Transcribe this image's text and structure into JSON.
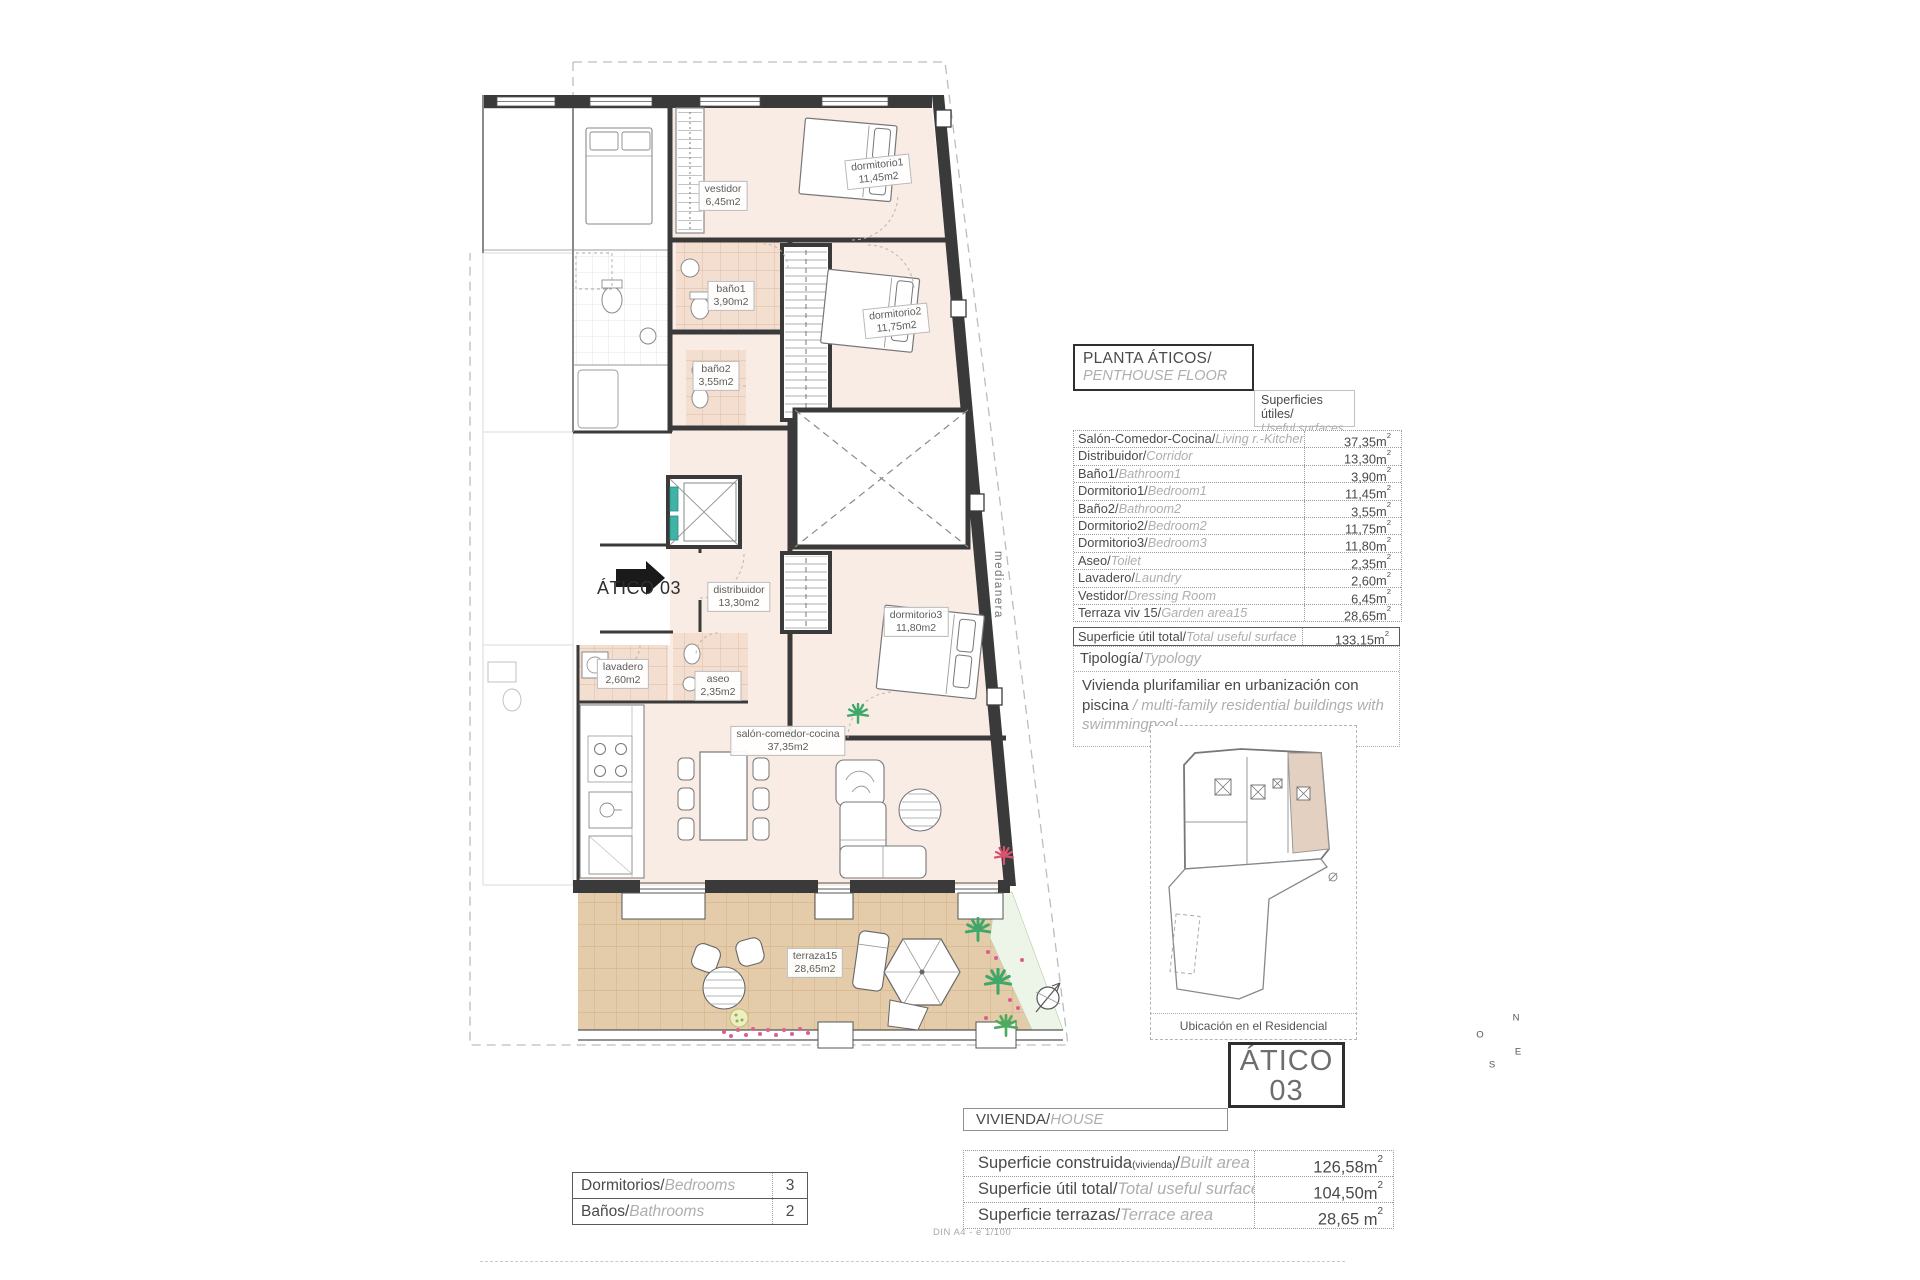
{
  "units": {
    "m": "m",
    "sup2": "2"
  },
  "page": {
    "footer": "DIN A4 - e 1/100"
  },
  "plan": {
    "arrow_label": "ÁTICO 03",
    "medianera": "medianera",
    "compass": {
      "n": "N",
      "o": "O",
      "s": "S",
      "e": "E"
    },
    "labels": [
      {
        "name": "vestidor",
        "area": "6,45m2"
      },
      {
        "name": "dormitorio1",
        "area": "11,45m2"
      },
      {
        "name": "baño1",
        "area": "3,90m2"
      },
      {
        "name": "baño2",
        "area": "3,55m2"
      },
      {
        "name": "dormitorio2",
        "area": "11,75m2"
      },
      {
        "name": "distribuidor",
        "area": "13,30m2"
      },
      {
        "name": "dormitorio3",
        "area": "11,80m2"
      },
      {
        "name": "lavadero",
        "area": "2,60m2"
      },
      {
        "name": "aseo",
        "area": "2,35m2"
      },
      {
        "name": "salón-comedor-cocina",
        "area": "37,35m2"
      },
      {
        "name": "terraza15",
        "area": "28,65m2"
      }
    ]
  },
  "title_block": {
    "es": "PLANTA ÁTICOS/",
    "en": "PENTHOUSE FLOOR"
  },
  "surfaces_header": {
    "es": "Superficies útiles/",
    "en": "Useful surfaces"
  },
  "surfaces_table": {
    "rows": [
      {
        "es": "Salón-Comedor-Cocina/",
        "en": "Living r.-Kitchen",
        "value": "37,35"
      },
      {
        "es": "Distribuidor/",
        "en": "Corridor",
        "value": "13,30"
      },
      {
        "es": "Baño1/",
        "en": "Bathroom1",
        "value": "3,90"
      },
      {
        "es": "Dormitorio1/",
        "en": "Bedroom1",
        "value": "11,45"
      },
      {
        "es": "Baño2/",
        "en": "Bathroom2",
        "value": "3,55"
      },
      {
        "es": "Dormitorio2/",
        "en": "Bedroom2",
        "value": "11,75"
      },
      {
        "es": "Dormitorio3/",
        "en": "Bedroom3",
        "value": "11,80"
      },
      {
        "es": "Aseo/",
        "en": "Toilet",
        "value": "2,35"
      },
      {
        "es": "Lavadero/",
        "en": "Laundry",
        "value": "2,60"
      },
      {
        "es": "Vestidor/",
        "en": "Dressing Room",
        "value": "6,45"
      },
      {
        "es": "Terraza viv 15/",
        "en": "Garden area15",
        "value": "28,65"
      }
    ],
    "total": {
      "es": "Superficie útil total/",
      "en": "Total useful surface",
      "value": "133,15"
    }
  },
  "typology": {
    "header_es": "Tipología/",
    "header_en": "Typology",
    "body_es": "Vivienda plurifamiliar en urbanización con piscina",
    "sep": " / ",
    "body_en": "multi-family residential buildings with swimmingpool"
  },
  "location": {
    "caption": "Ubicación en el Residencial"
  },
  "unit_box": {
    "line1": "ÁTICO",
    "line2": "03"
  },
  "vivienda_bar": {
    "es": "VIVIENDA/",
    "en": "HOUSE"
  },
  "house_table": {
    "rows": [
      {
        "es": "Superficie construida",
        "small": "(vivienda)",
        "slash": "/",
        "en": "Built area",
        "value": "126,58"
      },
      {
        "es": "Superficie útil total",
        "small": "",
        "slash": "/",
        "en": "Total useful surfaces",
        "value": "104,50"
      },
      {
        "es": "Superficie terrazas",
        "small": "",
        "slash": "/",
        "en": "Terrace area",
        "value": "28,65 "
      }
    ]
  },
  "rooms_table": {
    "rows": [
      {
        "es": "Dormitorios/",
        "en": "Bedrooms",
        "value": "3"
      },
      {
        "es": "Baños/",
        "en": "Bathrooms",
        "value": "2"
      }
    ]
  }
}
